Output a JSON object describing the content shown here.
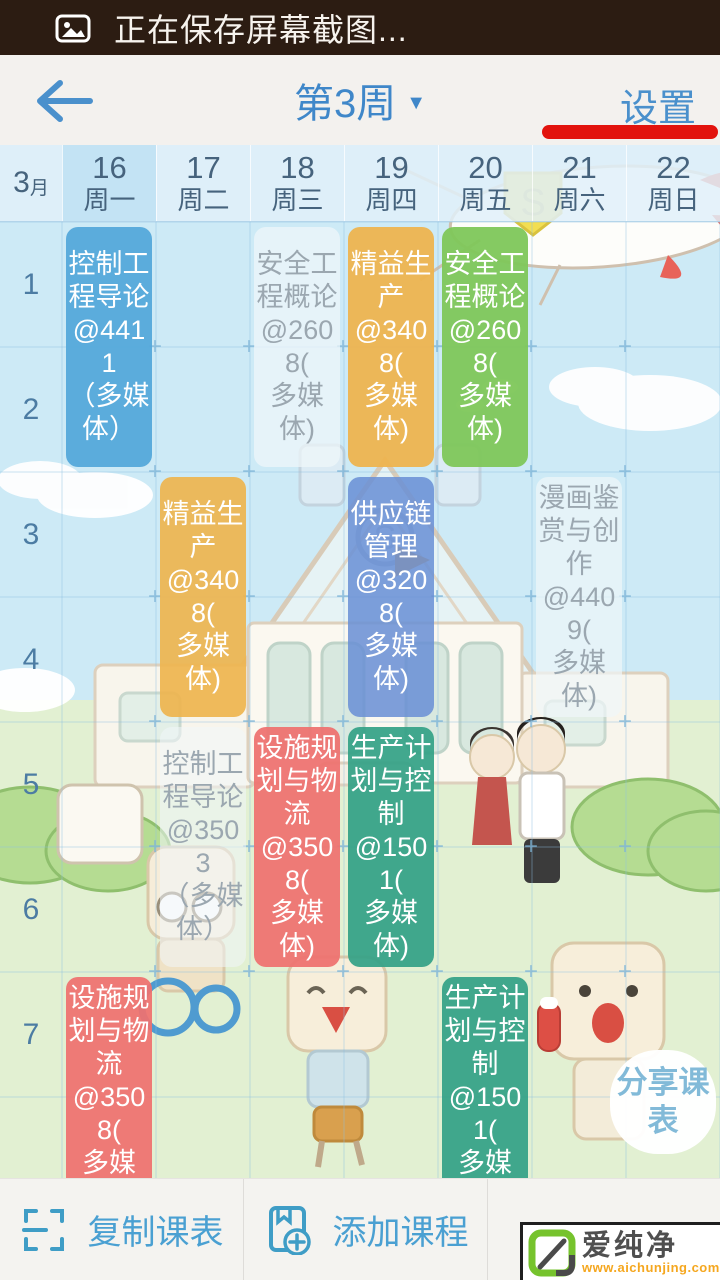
{
  "status_bar": {
    "text": "正在保存屏幕截图..."
  },
  "nav": {
    "week_label": "第3周",
    "settings_label": "设置",
    "underline_color": "#e2130d"
  },
  "calendar": {
    "month_num": "3",
    "month_unit": "月",
    "days": [
      {
        "date": "16",
        "weekday": "周一",
        "highlighted": true
      },
      {
        "date": "17",
        "weekday": "周二",
        "highlighted": false
      },
      {
        "date": "18",
        "weekday": "周三",
        "highlighted": false
      },
      {
        "date": "19",
        "weekday": "周四",
        "highlighted": false
      },
      {
        "date": "20",
        "weekday": "周五",
        "highlighted": false
      },
      {
        "date": "21",
        "weekday": "周六",
        "highlighted": false
      },
      {
        "date": "22",
        "weekday": "周日",
        "highlighted": false
      }
    ],
    "periods": [
      "1",
      "2",
      "3",
      "4",
      "5",
      "6",
      "7"
    ]
  },
  "courses": [
    {
      "name": "控制工程导论",
      "room": "@4411（多媒体）",
      "day": 0,
      "start": 0,
      "span": 2,
      "type": "solid",
      "bg": "rgba(86,169,219,0.96)",
      "color": "#ffffff",
      "lines": [
        "控制工",
        "程导论",
        "@4411",
        "（多媒",
        "体）"
      ]
    },
    {
      "name": "安全工程概论",
      "room": "@2608(多媒体)",
      "day": 2,
      "start": 0,
      "span": 2,
      "type": "ghost",
      "bg": "rgba(240,246,250,0.72)",
      "color": "#9ba7b0",
      "lines": [
        "安全工",
        "程概论",
        "@2608(",
        "多媒体)"
      ]
    },
    {
      "name": "精益生产",
      "room": "@3408(多媒体)",
      "day": 3,
      "start": 0,
      "span": 2,
      "type": "solid",
      "bg": "rgba(238,180,78,0.94)",
      "color": "#ffffff",
      "lines": [
        "精益生",
        "产",
        "@3408(",
        "多媒体)"
      ]
    },
    {
      "name": "安全工程概论",
      "room": "@2608(多媒体)",
      "day": 4,
      "start": 0,
      "span": 2,
      "type": "solid",
      "bg": "rgba(126,199,90,0.95)",
      "color": "#ffffff",
      "lines": [
        "安全工",
        "程概论",
        "@2608(",
        "多媒体)"
      ]
    },
    {
      "name": "精益生产",
      "room": "@3408(多媒体)",
      "day": 1,
      "start": 2,
      "span": 2,
      "type": "solid",
      "bg": "rgba(238,180,78,0.92)",
      "color": "#ffffff",
      "lines": [
        "精益生",
        "产",
        "@3408(",
        "多媒体)"
      ]
    },
    {
      "name": "供应链管理",
      "room": "@3208(多媒体)",
      "day": 3,
      "start": 2,
      "span": 2,
      "type": "solid",
      "bg": "rgba(105,143,213,0.86)",
      "color": "#ffffff",
      "lines": [
        "供应链",
        "管理",
        "@3208(",
        "多媒体)"
      ]
    },
    {
      "name": "漫画鉴赏与创作",
      "room": "@4409(多媒体)",
      "day": 5,
      "start": 2,
      "span": 2,
      "type": "ghost",
      "bg": "rgba(240,246,250,0.70)",
      "color": "#9ba7b0",
      "lines": [
        "漫画鉴",
        "赏与创",
        "作",
        "@4409(",
        "多媒体)"
      ]
    },
    {
      "name": "控制工程导论",
      "room": "@3503（多媒体）",
      "day": 1,
      "start": 4,
      "span": 2,
      "type": "ghost",
      "bg": "rgba(240,246,250,0.55)",
      "color": "#9ba7b0",
      "lines": [
        "控制工",
        "程导论",
        "@3503",
        "（多媒",
        "体）"
      ]
    },
    {
      "name": "设施规划与物流",
      "room": "@3508(多媒体)",
      "day": 2,
      "start": 4,
      "span": 2,
      "type": "solid",
      "bg": "rgba(238,114,112,0.94)",
      "color": "#ffffff",
      "lines": [
        "设施规",
        "划与物",
        "流",
        "@3508(",
        "多媒体)"
      ]
    },
    {
      "name": "生产计划与控制",
      "room": "@1501(多媒体)",
      "day": 3,
      "start": 4,
      "span": 2,
      "type": "solid",
      "bg": "rgba(52,161,134,0.93)",
      "color": "#ffffff",
      "lines": [
        "生产计",
        "划与控",
        "制",
        "@1501(",
        "多媒体)"
      ]
    },
    {
      "name": "设施规划与物流",
      "room": "@3508(多媒体)",
      "day": 0,
      "start": 6,
      "span": 2,
      "type": "solid",
      "bg": "rgba(238,114,112,0.94)",
      "color": "#ffffff",
      "lines": [
        "设施规",
        "划与物",
        "流",
        "@3508(",
        "多媒体)"
      ]
    },
    {
      "name": "生产计划与控制",
      "room": "@1501(多媒体)",
      "day": 4,
      "start": 6,
      "span": 2,
      "type": "solid",
      "bg": "rgba(52,161,134,0.93)",
      "color": "#ffffff",
      "lines": [
        "生产计",
        "划与控",
        "制",
        "@1501(",
        "多媒体)"
      ]
    }
  ],
  "share_bubble": {
    "label": "分享课表"
  },
  "bottom_bar": {
    "copy_label": "复制课表",
    "add_label": "添加课程"
  },
  "watermark": {
    "brand": "爱纯净",
    "url": "www.aichunjing.com",
    "logo_color": "#76c32d"
  }
}
